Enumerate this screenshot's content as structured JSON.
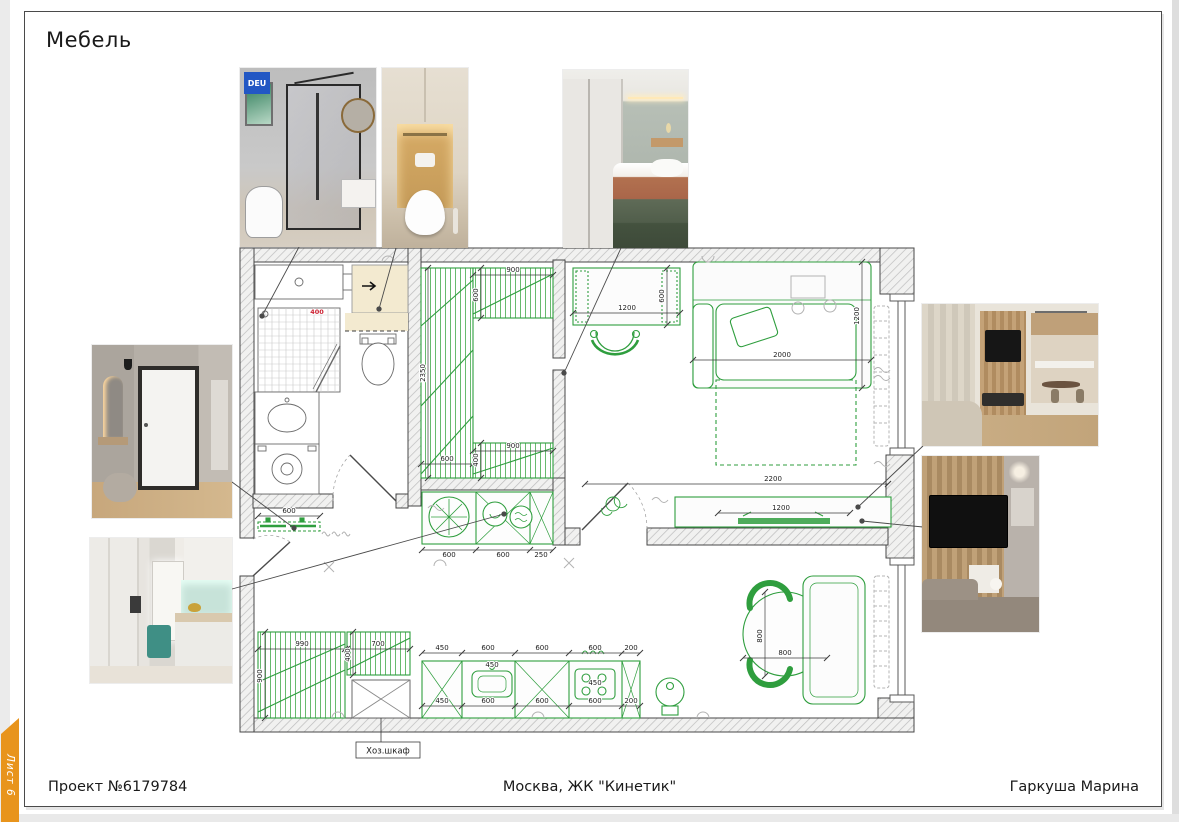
{
  "sheet": {
    "title": "Мебель",
    "tab_label": "Лист 6",
    "footer": {
      "project": "Проект №6179784",
      "location": "Москва, ЖК \"Кинетик\"",
      "author": "Гаркуша Марина"
    }
  },
  "plan": {
    "closet_label": "Хоз.шкаф",
    "dims": {
      "bath_400": "400",
      "w_top_900": "900",
      "w_top_600": "600",
      "w_2350": "2350",
      "w_bot_600": "600",
      "w_bot_900": "900",
      "w_bot_400": "400",
      "desk_1200": "1200",
      "desk_600": "600",
      "bed_2000": "2000",
      "bed_1200": "1200",
      "tv_2200": "2200",
      "tv_1200": "1200",
      "hall_600": "600",
      "hall_990": "990",
      "hall_900": "900",
      "hall_700": "700",
      "hall_400": "400",
      "ap_600a": "600",
      "ap_600b": "600",
      "ap_250": "250",
      "kt_450": "450",
      "kt_600a": "600",
      "kt_600b": "600",
      "kt_600c": "600",
      "kt_200": "200",
      "kt_450_in": "450",
      "kt_450_in2": "450",
      "kb_450": "450",
      "kb_600a": "600",
      "kb_600b": "600",
      "kb_600c": "600",
      "kb_200": "200",
      "tbl_800v": "800",
      "tbl_800h": "800"
    }
  },
  "photos": {
    "shower_badge": "DEU"
  },
  "colors": {
    "accent_orange": "#e8941c",
    "furniture_green": "#2f9e3e",
    "wall_hatch": "#bcbcbc",
    "note_red": "#cc2233",
    "badge_blue": "#2257c4"
  }
}
